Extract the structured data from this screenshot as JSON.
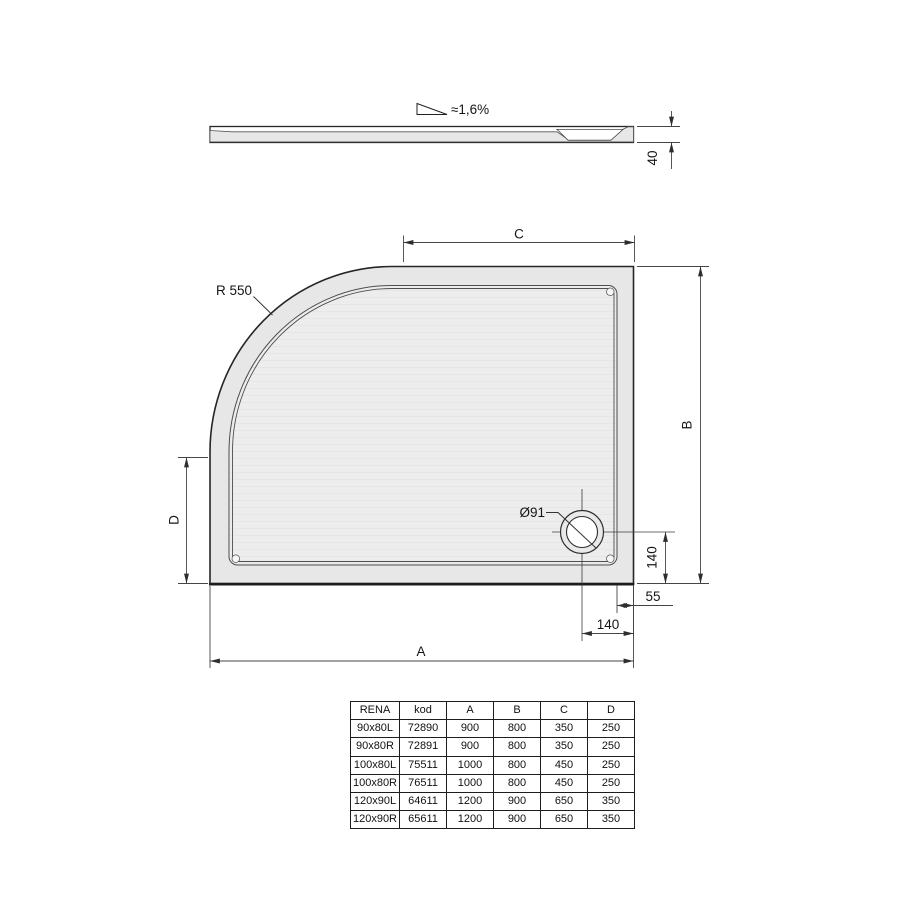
{
  "drawing": {
    "profile": {
      "slope_label": "≈1,6%",
      "height_dim": "40"
    },
    "plan": {
      "radius_label": "R 550",
      "drain_label": "Ø91",
      "dim_a": "A",
      "dim_b": "B",
      "dim_c": "C",
      "dim_d": "D",
      "drain_from_bottom_dim": "140",
      "drain_from_right_dim": "140",
      "rim_width_dim": "55"
    }
  },
  "table": {
    "headers": [
      "RENA",
      "kod",
      "A",
      "B",
      "C",
      "D"
    ],
    "rows": [
      [
        "90x80L",
        "72890",
        "900",
        "800",
        "350",
        "250"
      ],
      [
        "90x80R",
        "72891",
        "900",
        "800",
        "350",
        "250"
      ],
      [
        "100x80L",
        "75511",
        "1000",
        "800",
        "450",
        "250"
      ],
      [
        "100x80R",
        "76511",
        "1000",
        "800",
        "450",
        "250"
      ],
      [
        "120x90L",
        "64611",
        "1200",
        "900",
        "650",
        "350"
      ],
      [
        "120x90R",
        "65611",
        "1200",
        "900",
        "650",
        "350"
      ]
    ]
  },
  "colors": {
    "line": "#262626",
    "dim_line": "#454545",
    "tray_fill": "#e7e7e7",
    "floor_fill": "#ededed",
    "background": "#ffffff"
  }
}
